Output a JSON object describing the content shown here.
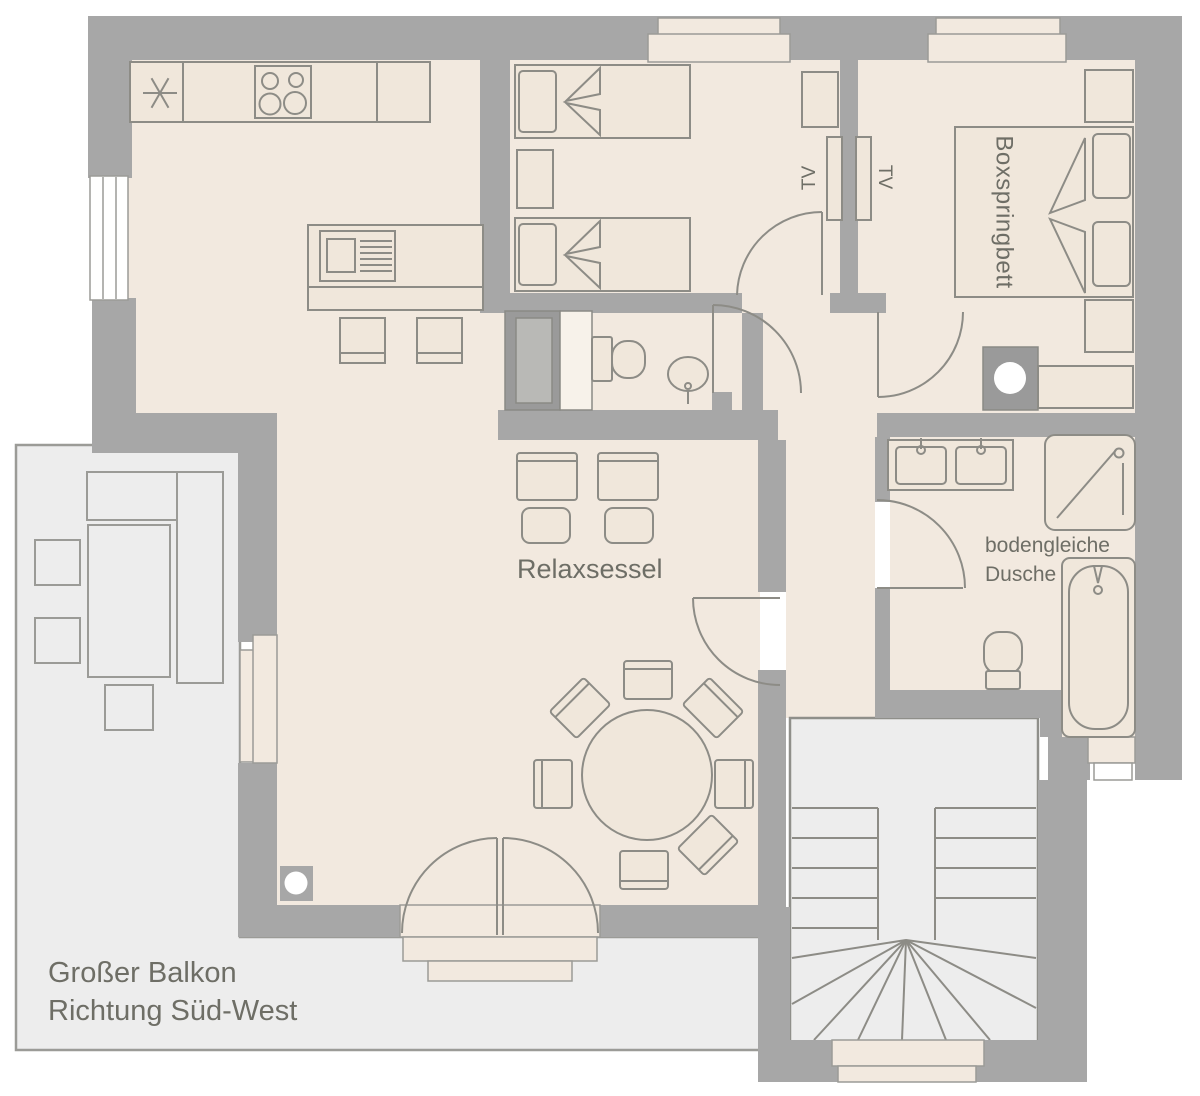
{
  "labels": {
    "master_bed": "Boxspringbett",
    "tv_left": "TV",
    "tv_right": "TV",
    "living_chairs": "Relaxsessel",
    "shower_line1": "bodengleiche",
    "shower_line2": "Dusche",
    "balcony_line1": "Großer Balkon",
    "balcony_line2": "Richtung Süd-West"
  },
  "colors": {
    "wall": "#a7a7a7",
    "wall_dark": "#9a9a9a",
    "floor": "#f2e9df",
    "balcony_floor": "#ededed",
    "outline": "#8d8c86",
    "balcony_outline": "#9b9b97",
    "text": "#6e6e66",
    "window": "#ffffff"
  },
  "icons": {
    "freezer_star_icon": "✳ six-spoke defrost asterisk",
    "stove_icon": "four burner circles",
    "sink_icon": "basin with drainer",
    "toilet_icon": "cistern and bowl",
    "shower_icon": "square tray with diagonal",
    "bathtub_icon": "rounded tub with tap",
    "washing_machine_icon": "dark square with white circle",
    "stair_icon": "U-shaped winder stair"
  }
}
